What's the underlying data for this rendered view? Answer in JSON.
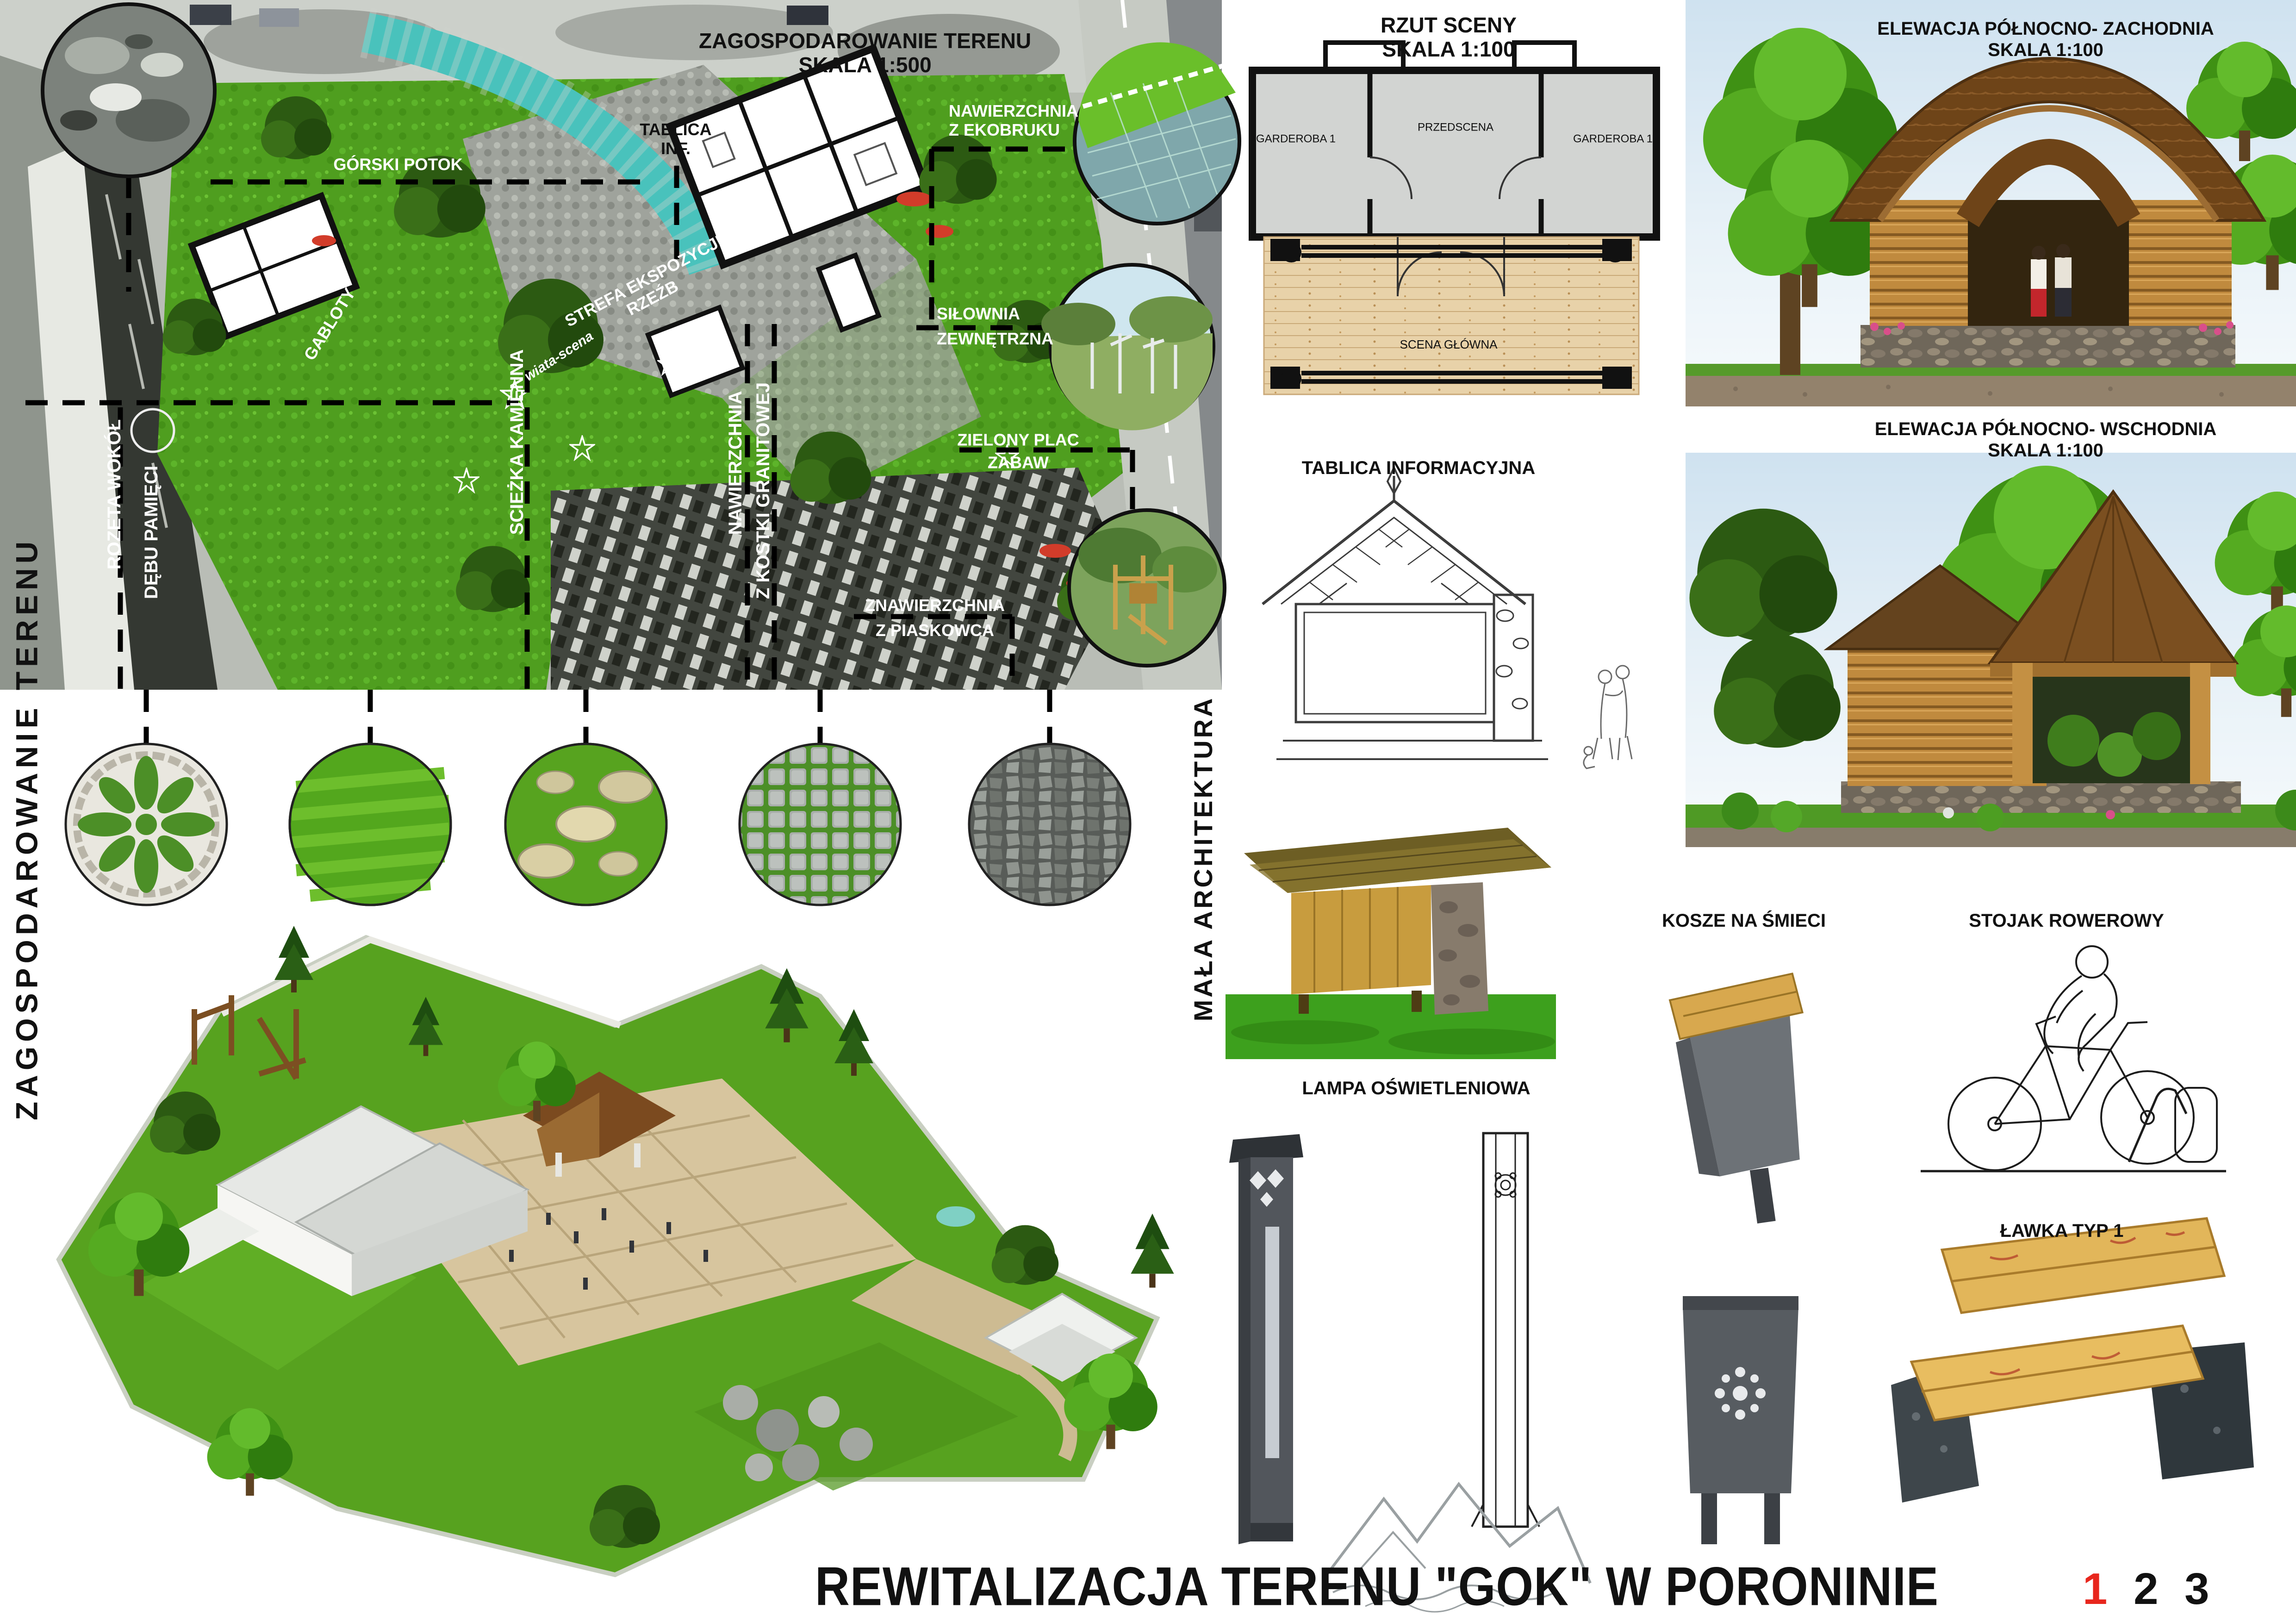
{
  "site_plan": {
    "title": "ZAGOSPODAROWANIE TERENU",
    "scale": "SKALA 1:500",
    "side_heading": "ZAGOSPODAROWANIE TERENU",
    "map_labels": {
      "stream": "GÓRSKI POTOK",
      "sculpture_zone_1": "STREFA EKSPOZYCJI",
      "sculpture_zone_2": "RZEŹB",
      "info_board_1": "TABLICA",
      "info_board_2": "INF.",
      "ecopaver_1": "NAWIERZCHNIA",
      "ecopaver_2": "Z EKOBRUKU",
      "gym_1": "SIŁOWNIA",
      "gym_2": "ZEWNĘTRZNA",
      "playground_1": "ZIELONY PLAC",
      "playground_2": "ZABAW",
      "sandstone_1": "ZNAWIERZCHNIA",
      "sandstone_2": "Z PIASKOWCA",
      "stone_path": "SCIEŻKA KAMIENNA",
      "granite_1": "NAWIERZCHNIA",
      "granite_2": "Z KOSTKI GRANITOWEJ",
      "rosette_1": "ROZETA WOKÓŁ",
      "rosette_2": "DĘBU PAMIĘCI",
      "display_cases": "GABLOTY",
      "stage_shelter": "wiata-scena"
    }
  },
  "stage_plan": {
    "title": "RZUT SCENY",
    "scale": "SKALA 1:100",
    "room_left": "GARDEROBA 1",
    "room_center": "PRZEDSCENA",
    "room_right": "GARDEROBA 1",
    "stage": "SCENA GŁÓWNA"
  },
  "small_architecture": {
    "section_heading": "MAŁA ARCHITEKTURA",
    "info_board_title": "TABLICA INFORMACYJNA",
    "lamp_title": "LAMPA OŚWIETLENIOWA",
    "bins_title": "KOSZE NA ŚMIECI",
    "bike_rack_title": "STOJAK ROWEROWY",
    "bench_title": "ŁAWKA TYP 1"
  },
  "elevations": {
    "nw_title": "ELEWACJA PÓŁNOCNO- ZACHODNIA",
    "nw_scale": "SKALA 1:100",
    "ne_title": "ELEWACJA PÓŁNOCNO- WSCHODNIA",
    "ne_scale": "SKALA 1:100"
  },
  "footer": {
    "title": "REWITALIZACJA TERENU \"GOK\" W PORONINIE",
    "pages": [
      "1",
      "2",
      "3"
    ],
    "active_page": "1"
  },
  "colors": {
    "page_active": "#e8261d",
    "map_label": "#ffffff",
    "text": "#111111"
  }
}
